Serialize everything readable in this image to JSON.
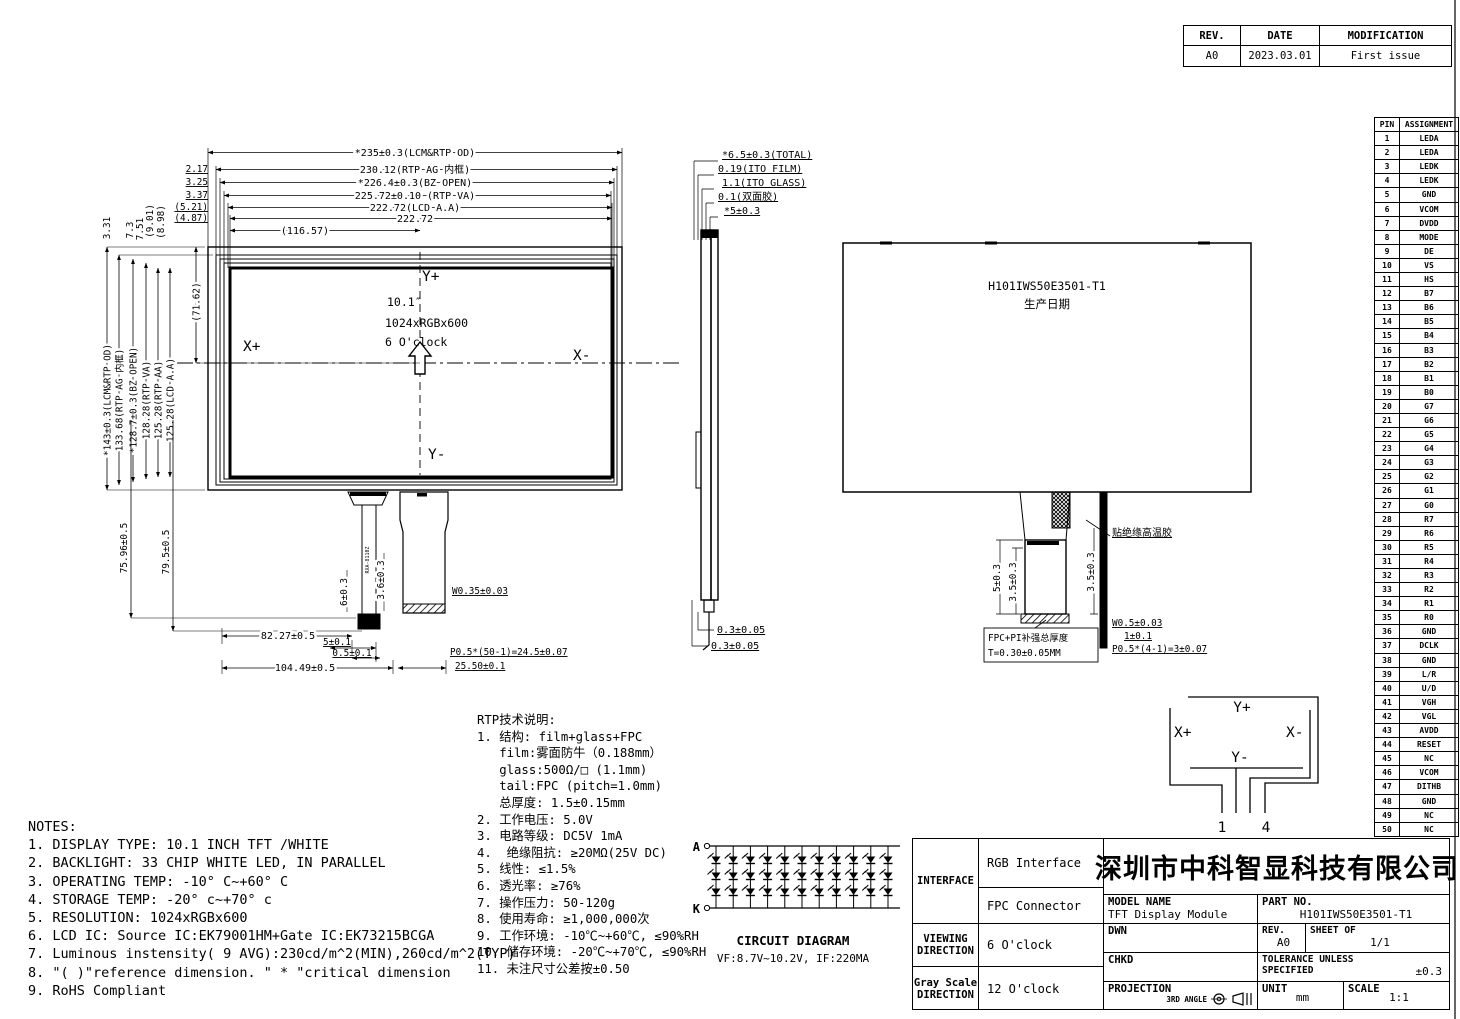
{
  "revision_table": {
    "headers": [
      "REV.",
      "DATE",
      "MODIFICATION"
    ],
    "row": [
      "A0",
      "2023.03.01",
      "First issue"
    ]
  },
  "pin_table": {
    "headers": [
      "PIN",
      "ASSIGNMENT"
    ],
    "assignments": [
      "LEDA",
      "LEDA",
      "LEDK",
      "LEDK",
      "GND",
      "VCOM",
      "DVDD",
      "MODE",
      "DE",
      "VS",
      "HS",
      "B7",
      "B6",
      "B5",
      "B4",
      "B3",
      "B2",
      "B1",
      "B0",
      "G7",
      "G6",
      "G5",
      "G4",
      "G3",
      "G2",
      "G1",
      "G0",
      "R7",
      "R6",
      "R5",
      "R4",
      "R3",
      "R2",
      "R1",
      "R0",
      "GND",
      "DCLK",
      "GND",
      "L/R",
      "U/D",
      "VGH",
      "VGL",
      "AVDD",
      "RESET",
      "NC",
      "VCOM",
      "DITHB",
      "GND",
      "NC",
      "NC"
    ]
  },
  "front_view": {
    "top_dims": [
      "*235±0.3(LCM&RTP OD)",
      "230.12(RTP AG 内框)",
      "*226.4±0.3(BZ OPEN)",
      "225.72±0.10 (RTP VA)",
      "222.72(LCD A.A)",
      "222.72",
      "(116.57)"
    ],
    "top_offsets": [
      "2.17",
      "3.25",
      "3.37",
      "(5.21)",
      "(4.87)"
    ],
    "top_voffsets": [
      "3.31",
      "7.3",
      "7.51",
      "(9.01)",
      "(8.98)"
    ],
    "left_dims": [
      "*143±0.3(LCM&RTP OD)",
      "133.68(RTP AG 内框)",
      "*128.7±0.3(BZ OPEN)",
      "128.28(RTP VA)",
      "125.28(RTP AA)",
      "125.28(LCD A.A)",
      "(71.62)"
    ],
    "axis": {
      "y_plus": "Y+",
      "y_minus": "Y-",
      "x_plus": "X+",
      "x_minus": "X-"
    },
    "center_text": [
      "10.1″",
      "1024xRGBx600",
      "6 O'clock"
    ],
    "fpc_label": "RXA-8110Z",
    "bottom": {
      "v1": "75.96±0.5",
      "v2": "79.5±0.5",
      "bl": "6±0.3",
      "fpc": "3.6±0.3",
      "w": "W0.35±0.03",
      "a": "82.27±0.5",
      "b": "5±0.1",
      "c": "0.5±0.1",
      "d": "104.49±0.5",
      "p": "P0.5*(50-1)=24.5±0.07",
      "e": "25.50±0.1"
    }
  },
  "side_view": {
    "top_dims": [
      "*6.5±0.3(TOTAL)",
      "0.19(ITO FILM)",
      "1.1(ITO GLASS)",
      "0.1(双面胶)",
      "*5±0.3"
    ],
    "bottom_dims": [
      "0.3±0.05",
      "0.3±0.05"
    ]
  },
  "back_view": {
    "model": "H101IWS50E3501-T1",
    "date_label": "生产日期",
    "tape_label": "贴绝缘高温胶",
    "dim_5": "5±0.3",
    "dim_35a": "3.5±0.3",
    "dim_35b": "3.5±0.3",
    "finger_w": "W0.5±0.03",
    "dim_1": "1±0.1",
    "pitch": "P0.5*(4-1)=3±0.07",
    "stiffener_line1": "FPC+PI补强总厚度",
    "stiffener_line2": "T=0.30±0.05MM"
  },
  "touch_diagram": {
    "y_plus": "Y+",
    "y_minus": "Y-",
    "x_plus": "X+",
    "x_minus": "X-",
    "pin_first": "1",
    "pin_last": "4"
  },
  "rtp_notes": {
    "title": "RTP技术说明:",
    "lines": [
      "1. 结构: film+glass+FPC",
      "   film:雾面防牛（0.188mm）",
      "   glass:500Ω/□ (1.1mm)",
      "   tail:FPC (pitch=1.0mm)",
      "   总厚度: 1.5±0.15mm",
      "2. 工作电压: 5.0V",
      "3. 电路等级: DC5V 1mA",
      "4.  绝缘阻抗: ≥20MΩ(25V DC)",
      "5. 线性: ≤1.5%",
      "6. 透光率: ≥76%",
      "7. 操作压力: 50-120g",
      "8. 使用寿命: ≥1,000,000次",
      "9. 工作环境: -10℃~+60℃, ≤90%RH",
      "10. 储存环境: -20℃~+70℃, ≤90%RH",
      "11. 未注尺寸公差按±0.50"
    ]
  },
  "notes": {
    "title": "NOTES:",
    "lines": [
      "1. DISPLAY TYPE: 10.1 INCH TFT /WHITE",
      "2. BACKLIGHT: 33 CHIP WHITE LED, IN PARALLEL",
      "3. OPERATING TEMP: -10° C~+60° C",
      "4. STORAGE TEMP: -20° c~+70° c",
      "5. RESOLUTION: 1024xRGBx600",
      "6. LCD IC: Source IC:EK79001HM+Gate IC:EK73215BCGA",
      "7. Luminous instensity( 9 AVG):230cd/m^2(MIN),260cd/m^2(TYP)",
      "8. \"( )\"reference dimension. \" * \"critical dimension",
      "9. RoHS Compliant"
    ]
  },
  "circuit": {
    "anode": "A",
    "cathode": "K",
    "title": "CIRCUIT DIAGRAM",
    "spec": "VF:8.7V~10.2V, IF:220MA",
    "columns": 11,
    "rows": 3
  },
  "title_block": {
    "interface_label": "INTERFACE",
    "interface_value1": "RGB Interface",
    "interface_value2": "FPC Connector",
    "viewing_label_1": "VIEWING",
    "viewing_label_2": "DIRECTION",
    "viewing_value": "6 O'clock",
    "gray_label_1": "Gray Scale",
    "gray_label_2": "DIRECTION",
    "gray_value": "12 O'clock",
    "company": "深圳市中科智显科技有限公司",
    "model_name_label": "MODEL NAME",
    "model_name": "TFT Display Module",
    "part_no_label": "PART NO.",
    "part_no": "H101IWS50E3501-T1",
    "dwn_label": "DWN",
    "chkd_label": "CHKD",
    "rev_label": "REV.",
    "rev": "A0",
    "sheet_label": "SHEET OF",
    "sheet": "1/1",
    "tolerance_label_1": "TOLERANCE UNLESS",
    "tolerance_label_2": "SPECIFIED",
    "tolerance": "±0.3",
    "projection_label": "PROJECTION",
    "projection": "3RD ANGLE",
    "unit_label": "UNIT",
    "unit": "mm",
    "scale_label": "SCALE",
    "scale": "1:1"
  }
}
